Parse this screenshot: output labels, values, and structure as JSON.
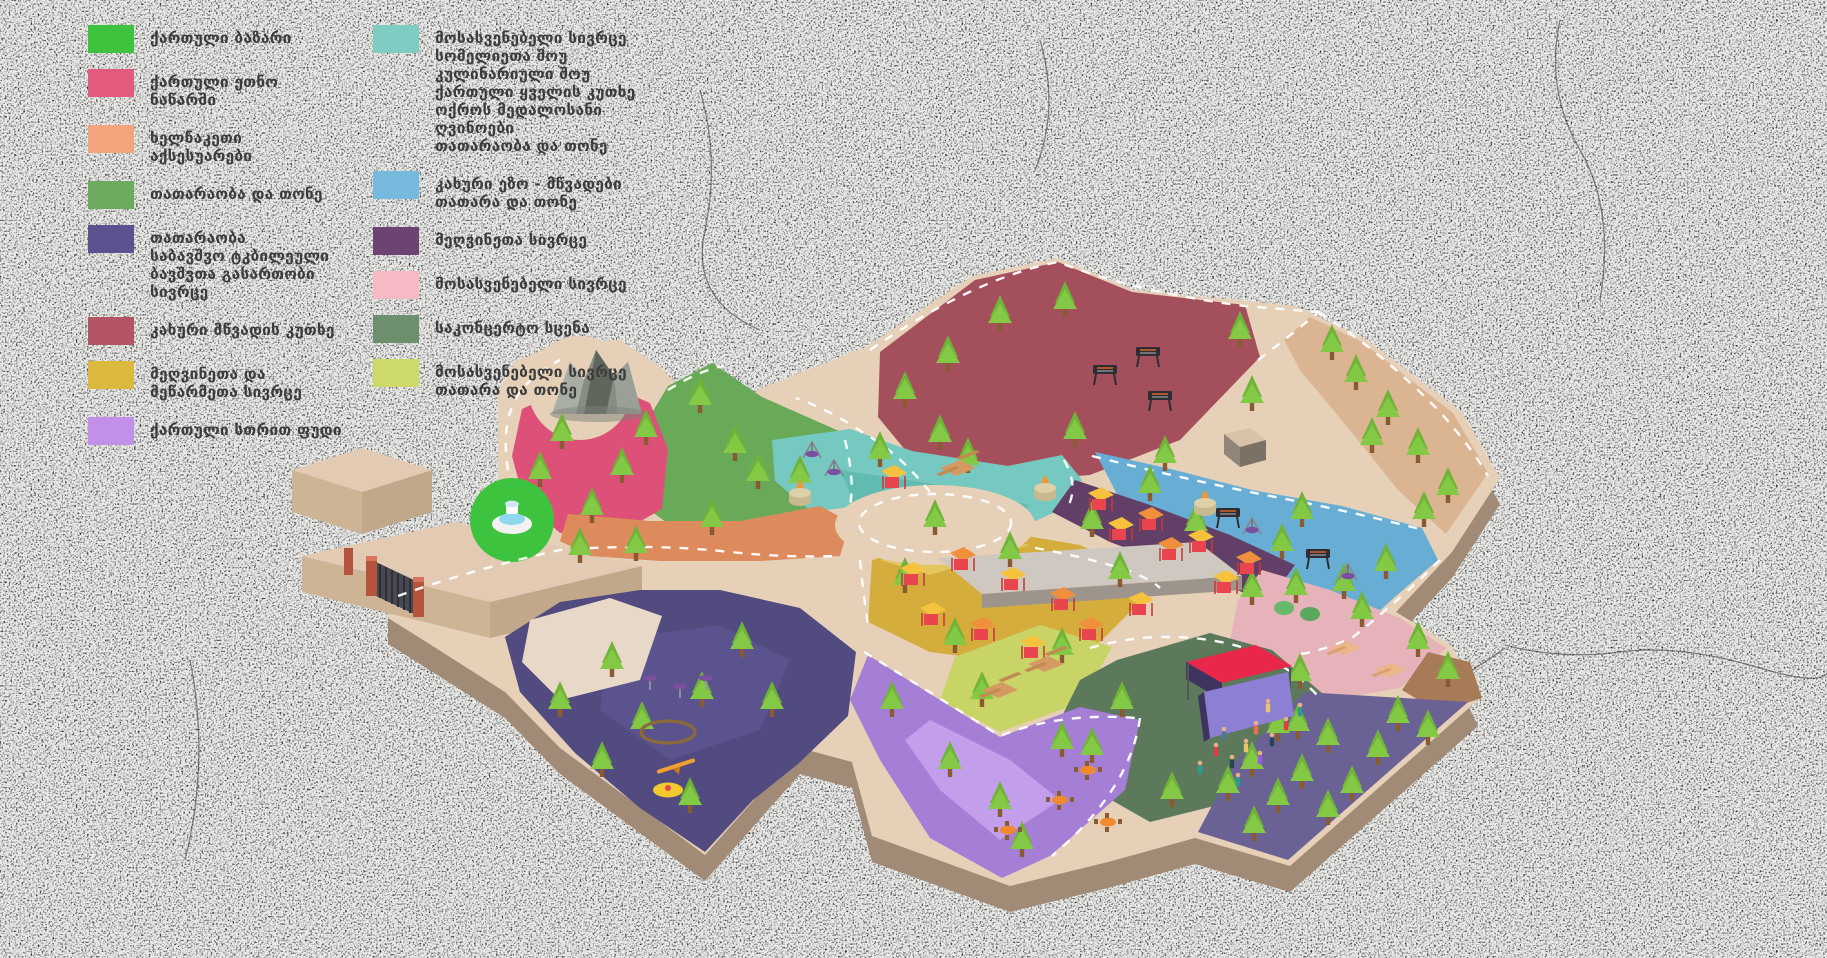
{
  "background": {
    "base_color": "#ebebe9",
    "speckle_color": "#2a2a2a"
  },
  "legend": {
    "text_color": "#3c3c3c",
    "column1": [
      {
        "color": "#3ec33e",
        "label": "ქართული ბაზარი"
      },
      {
        "color": "#e25b7d",
        "label": "ქართული ეთნო ნაწარმი"
      },
      {
        "color": "#f4a47d",
        "label": "ხელნაკეთი აქსესუარები"
      },
      {
        "color": "#6cab5e",
        "label": "თათარაობა და თონე"
      },
      {
        "color": "#5b5290",
        "label": "თათარაობა\nსაბავშვო ტკბილეული\nბავშვთა გასართობი სივრცე"
      },
      {
        "color": "#b45566",
        "label": "კახური მწვადის კუთხე"
      },
      {
        "color": "#ddb83f",
        "label": "მეღვინეთა და\nმეწარმეთა სივრცე"
      },
      {
        "color": "#c28fe9",
        "label": "ქართული სთრით ფუდი"
      }
    ],
    "column2": [
      {
        "color": "#7fcdc2",
        "label": "მოსასვენებელი სივრცე\nსომელიეთა შოუ\nკულინარიული შოუ\nქართული ყველის კუთხე\nოქროს მედალოსანი ღვინოები\nთათარაობა და თონე"
      },
      {
        "color": "#76badd",
        "label": "კახური ეზო - მწვადები\nთათარა და თონე"
      },
      {
        "color": "#6d4471",
        "label": "მეღვინეთა სივრცე"
      },
      {
        "color": "#f5bac4",
        "label": "მოსასვენებელი სივრცე"
      },
      {
        "color": "#6d8f6d",
        "label": "საკონცერტო სცენა"
      },
      {
        "color": "#cdd968",
        "label": "მოსასვენებელი სივრცე\nთათარა და თონე"
      }
    ]
  },
  "map": {
    "ground_color": "#e7d0b8",
    "side_color": "#a18b76",
    "building_top": "#e2cbb2",
    "building_side": "#c2a88b",
    "zones": {
      "mtsvadi_maroon": {
        "name": "კახური მწვადის კუთხე",
        "color": "#a4505c"
      },
      "tan_trees": {
        "name": "ხეები ბილიკზე",
        "color": "#dbb492"
      },
      "tone_green": {
        "name": "თათარაობა და თონე",
        "color": "#69aa58"
      },
      "ethno_pink": {
        "name": "ქართული ეთნო ნაწარმი",
        "color": "#dd5078"
      },
      "rest_teal": {
        "name": "მოსასვენებელი სივრცე",
        "color": "#76c9c0"
      },
      "kakhuri_blue": {
        "name": "კახური ეზო - მწვადები",
        "color": "#68aed4"
      },
      "wine_plum": {
        "name": "მეღვინეთა სივრცე",
        "color": "#613f66"
      },
      "wine_yellow": {
        "name": "მეღვინეთა და მეწარმეთა სივრცე",
        "color": "#d4ad3c"
      },
      "rest_yellowgreen": {
        "name": "მოსასვენებელი სივრცე / თათარა",
        "color": "#c8d566"
      },
      "rest_pink": {
        "name": "მოსასვენებელი სივრცე",
        "color": "#e7b3ba"
      },
      "stage_sage": {
        "name": "საკონცერტო სცენა",
        "color": "#5c795c"
      },
      "streetfood_lav": {
        "name": "ქართული სთრით ფუდი",
        "color": "#a57fd6"
      },
      "playground": {
        "name": "ბავშვთა გასართობი სივრცე",
        "color": "#514b80"
      },
      "forest_purple": {
        "name": "მოსასვენებელი სივრცე თათარა და თონე",
        "color": "#6a6195"
      },
      "accessories_band": {
        "name": "ხელნაკეთი აქსესუარები",
        "color": "#dd8a5c"
      },
      "bazaar_circle": {
        "name": "ქართული ბაზარი",
        "color": "#3ec33e"
      },
      "brown_patch": {
        "name": "ბილიკი",
        "color": "#a87b58"
      }
    },
    "features": [
      "entrance-gate",
      "fountain",
      "rock-mountain",
      "roundabout",
      "warehouse",
      "concert-stage",
      "bbq-grills",
      "market-stalls",
      "picnic-tables",
      "street-food-tables",
      "playground-equipment",
      "trees"
    ]
  }
}
